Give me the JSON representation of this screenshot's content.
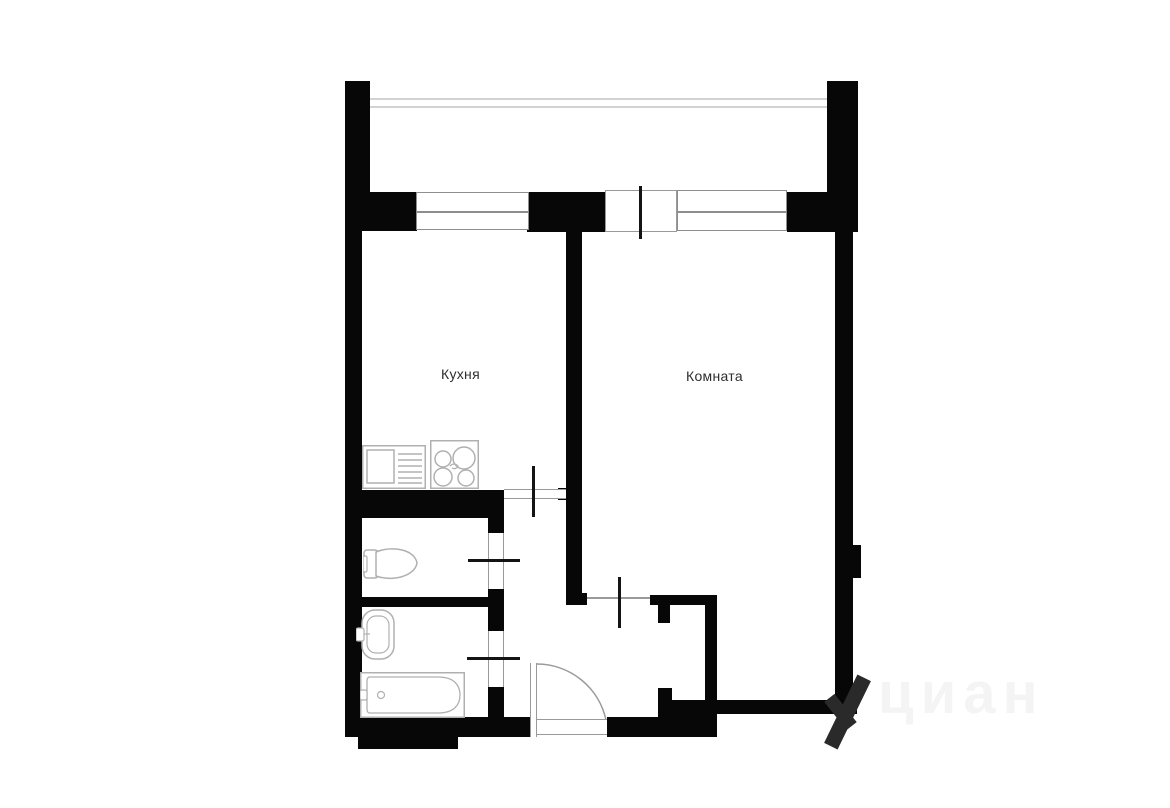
{
  "title": "apartment-floor-plan",
  "labels": {
    "kitchen": "Кухня",
    "room": "Комната"
  },
  "watermark": {
    "text": "циан"
  },
  "fixtures": {
    "kitchen_sink": "kitchen-sink-counter",
    "stove": "four-burner-stove",
    "toilet": "toilet",
    "wash_basin": "wash-basin",
    "bathtub": "bathtub"
  },
  "colors": {
    "background": "#ffffff",
    "wall": "#070707",
    "window_frame": "#8e8e8e",
    "opening_frame": "#9a9a9a",
    "door_tick": "#141414",
    "balcony_railing": "#d2d2d2",
    "fixture_stroke": "#b0b0b0",
    "label_text": "#2e2e2e",
    "watermark_text": "rgba(0,0,0,0.045)",
    "watermark_mark": "#2a2a2a"
  }
}
